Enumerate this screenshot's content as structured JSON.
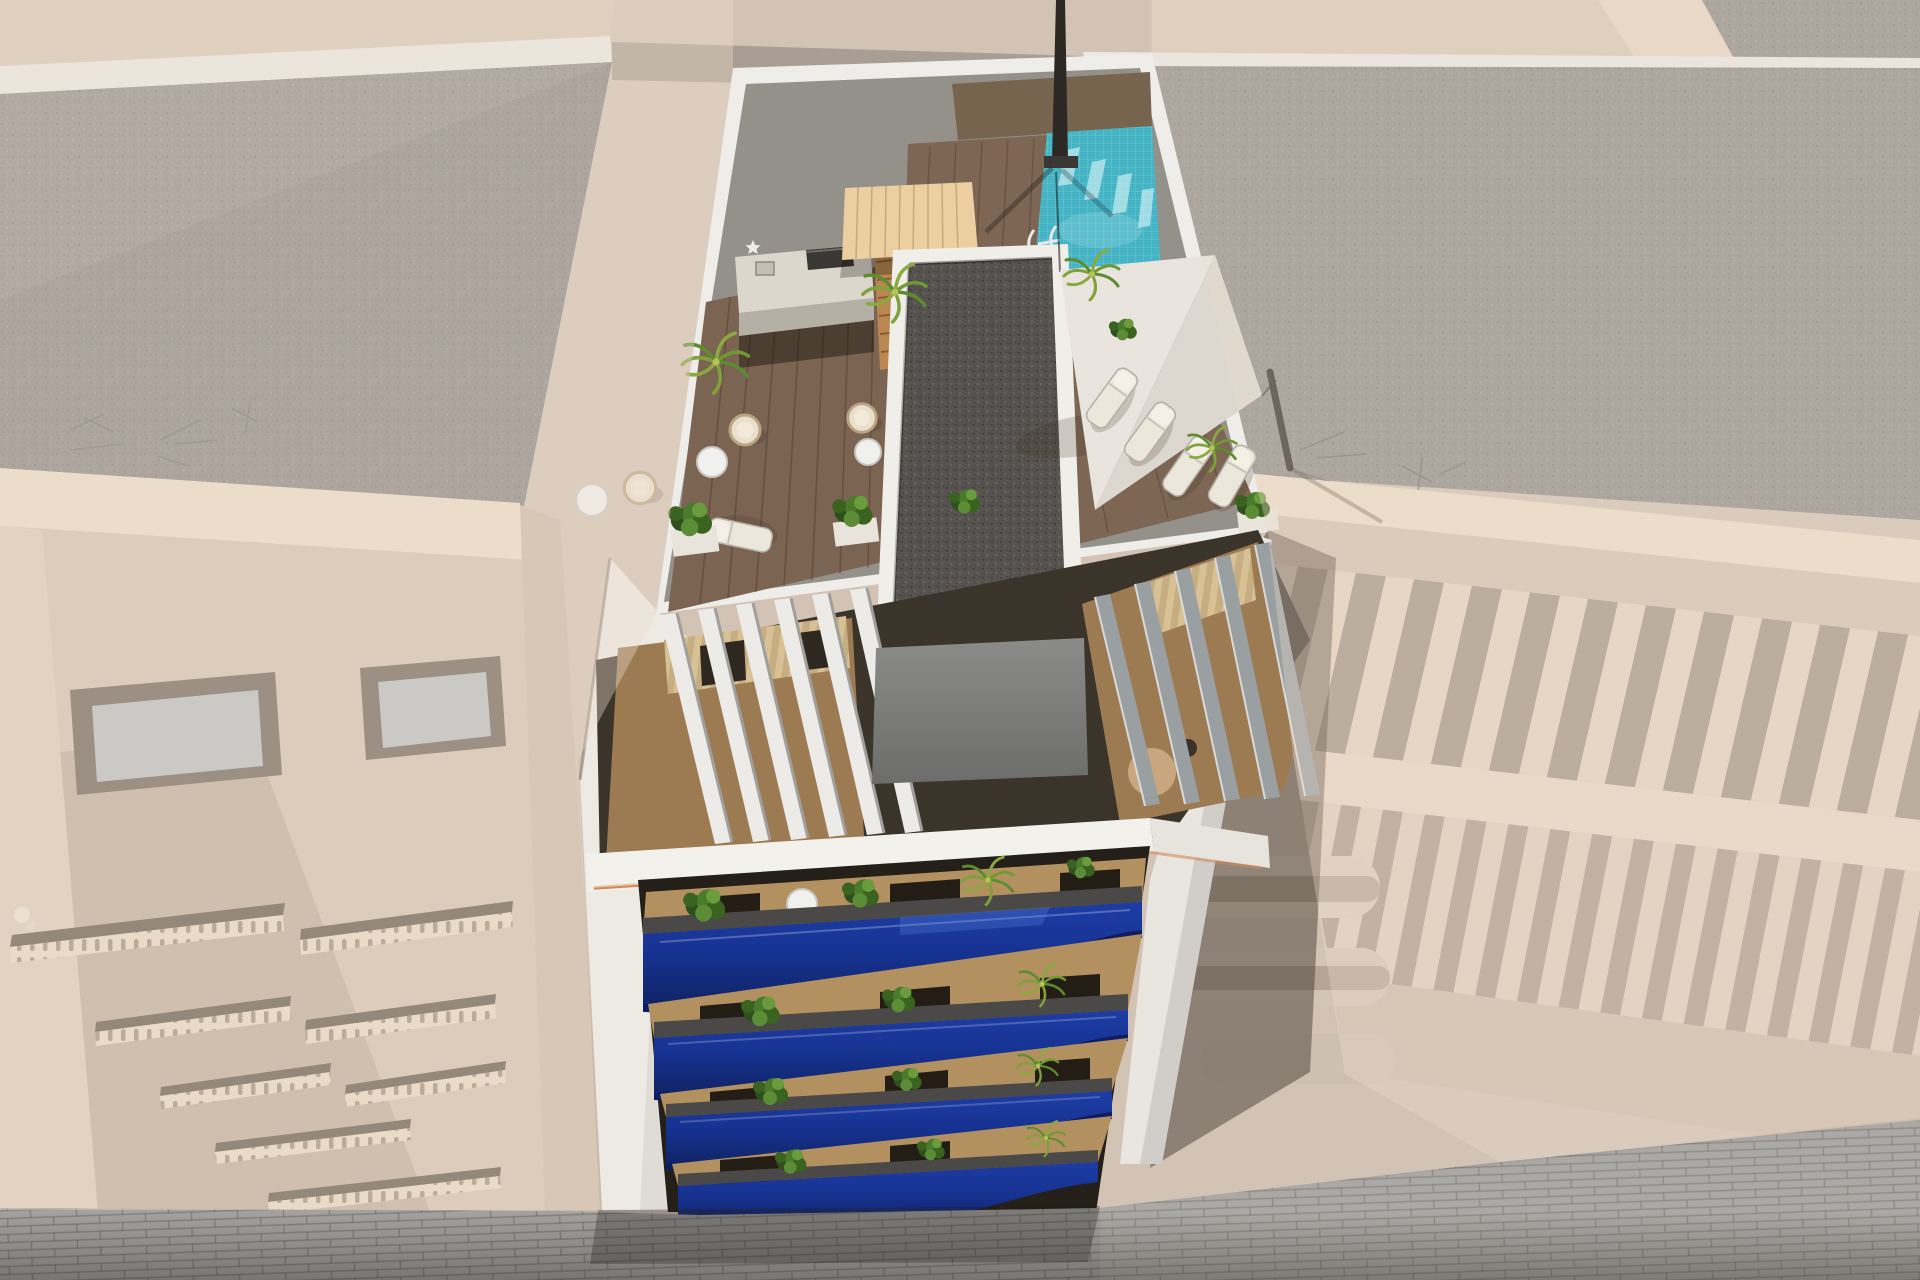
{
  "scene": {
    "kind": "3d-aerial-architectural-render",
    "subject": "new-build apartment tower with rooftop pool terrace and blue wave balconies, between two existing beige buildings"
  },
  "colors": {
    "background_beige": "#d2c3b5",
    "background_wall_gray": "#a89e93",
    "neighbor_facade": "#d3c2b2",
    "neighbor_facade_sunlit": "#ecdcc9",
    "neighbor_facade_shadow": "#b4a291",
    "neighbor_window": "#bcc5c9",
    "neighbor_recess": "#6a6156",
    "gravel_roof": "#8e8c89",
    "parapet_white": "#efede9",
    "main_roof_gray": "#94908a",
    "pool_water": "#45b5c6",
    "pool_wall_wood": "#77644f",
    "deck_wood": "#7d6654",
    "deck_wood_left": "#7c6452",
    "pergola_wood": "#eccfa0",
    "slat_wall_wood": "#b9874f",
    "kitchen_counter": "#dcd7cd",
    "core_frame": "#f0eee9",
    "core_gravel": "#575350",
    "core_face": "#8b8b89",
    "louver_white": "#ecebe7",
    "louver_gray": "#9aa0a2",
    "terrace_wood": "#9c7a52",
    "curtain_beige": "#d9c196",
    "setback_dark": "#3a342b",
    "west_wall_white": "#edeae4",
    "fascia_white": "#f3f1ec",
    "led_copper": "#cd8a5c",
    "balcony_backdrop": "#241f18",
    "balcony_floor_tan": "#b2905f",
    "balcony_top_granite": "#4b4947",
    "balcony_blue": "#16318f",
    "balcony_blue_dark": "#0c1d63",
    "plant_green": "#4a7a2c",
    "palm_green": "#8aa93f",
    "sail_white": "#e9e5de",
    "sail_shaded": "#ddd8cf",
    "lounger_white": "#ece7db",
    "street_brick": "#a3a2a0",
    "pole_dark": "#2c2925"
  }
}
